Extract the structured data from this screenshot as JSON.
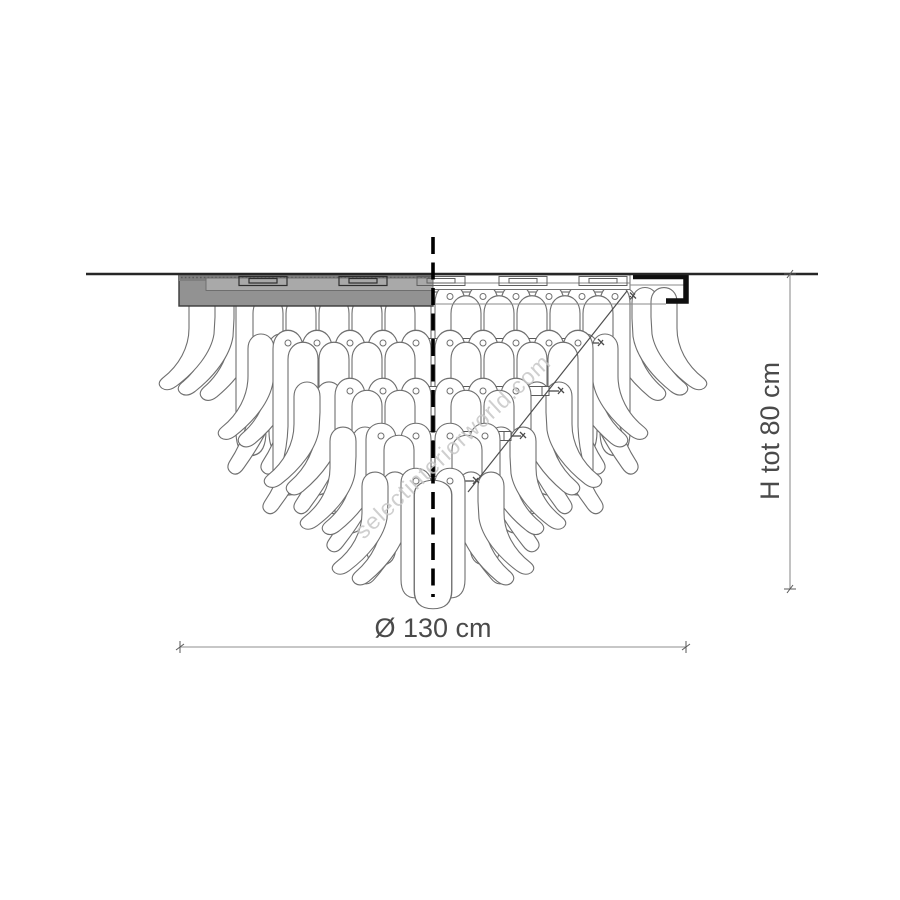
{
  "page": {
    "background": "#ffffff"
  },
  "drawing": {
    "watermark_text": "selectinteriorworld.com",
    "dimensions": {
      "diameter_label": "Ø 130 cm",
      "diameter_cm": 130,
      "height_label": "H tot 80 cm",
      "total_height_cm": 80
    },
    "colors": {
      "outline": "#6f6f6f",
      "dark_line": "#1a1a1a",
      "canopy_fill": "#929292",
      "dimension_text": "#4a4a4a",
      "watermark": "#c7c7c7"
    }
  }
}
